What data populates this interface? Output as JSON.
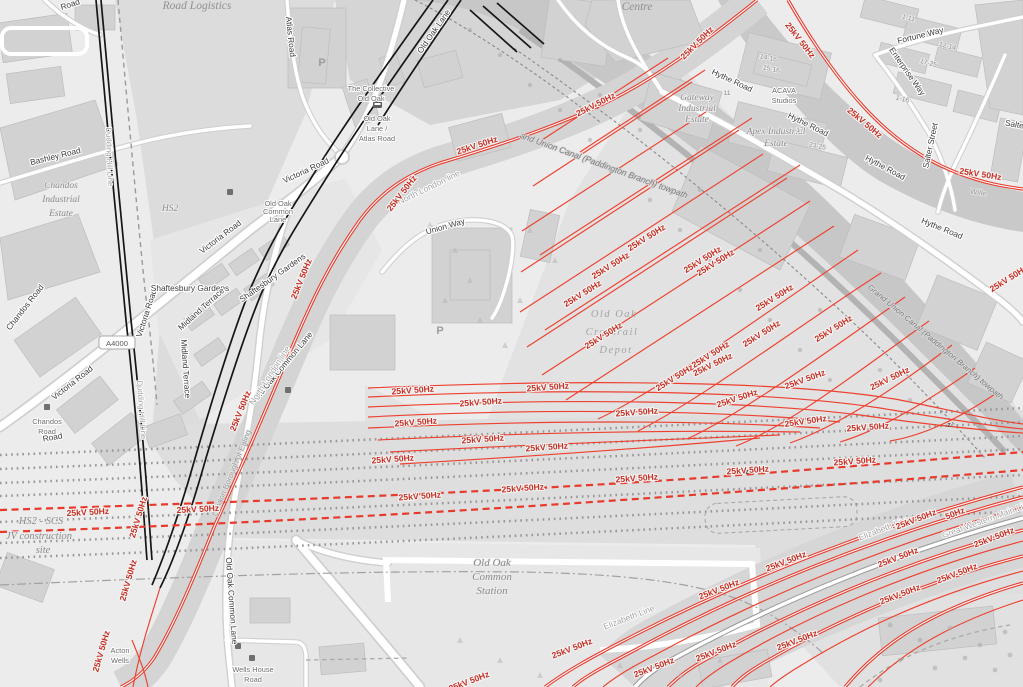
{
  "map": {
    "electrification_label": "25kV 50Hz",
    "electrification_label_short": "50Hz",
    "road_ref_a4000": "A4000",
    "streets": {
      "road_fragment": "Road",
      "atlas_road": "Atlas Road",
      "old_oak_lane": "Old Oak Lane",
      "bashley_road": "Bashley Road",
      "victoria_road": "Victoria Road",
      "old_oak_common_lane": "Old Oak Common Lane",
      "chandos_road": "Chandos Road",
      "shaftesbury_gardens": "Shaftesbury Gardens",
      "midland_terrace": "Midland Terrace",
      "union_way": "Union Way",
      "hythe_road": "Hythe Road",
      "fortune_way": "Fortune Way",
      "enterprise_way": "Enterprise Way",
      "salter_street": "Salter Street",
      "salter_fragment": "Salte",
      "willesden_fragment": "Wille",
      "wells_house_road": [
        "Wells House",
        "Road"
      ]
    },
    "places": {
      "road_logistics": "Road Logistics",
      "centre": "Centre",
      "the_collective": [
        "The Collective",
        "Old Oak"
      ],
      "old_oak_lane_atlas_road": [
        "Old Oak",
        "Lane /",
        "Atlas Road"
      ],
      "old_oak_common_lane_stop": [
        "Old Oak",
        "Common",
        "Lane"
      ],
      "hs2": "HS2",
      "chandos_industrial_estate": [
        "Chandos",
        "Industrial",
        "Estate"
      ],
      "gateway_industrial_estate": [
        "Gateway",
        "Industrial",
        "Estate"
      ],
      "apex_industrial_estate": [
        "Apex Industrial",
        "Estate"
      ],
      "acava_studios": [
        "ACAVA",
        "Studios"
      ],
      "old_oak_crossrail_depot": [
        "Old Oak",
        "Crossrail",
        "Depot"
      ],
      "old_oak_common_station": [
        "Old Oak",
        "Common",
        "Station"
      ],
      "hs2_scs_site": [
        "HS2 - SCS",
        "JV construction",
        "site"
      ],
      "acton_wells": [
        "Acton",
        "Wells"
      ],
      "chandos_road_stop": [
        "Chandos",
        "Road"
      ]
    },
    "railways": {
      "north_london_line": "North London line",
      "dudding_hill_line": "Dudding Hill Line",
      "elizabeth_line": "Elizabeth Line",
      "great_western_main_line": "Great Western Main Line"
    },
    "waterway": {
      "canal_label_partial": "and Union Canal (Paddington Branch) towpath",
      "canal_label_full": "Grand Union Canal (Paddington Branch) towpath"
    },
    "boundary": {
      "ealing": "London Borough of Ealing"
    },
    "house_numbers": {
      "a": "1-11",
      "b": "12-14",
      "c": "17-25",
      "d": "1-16",
      "e": "14-16",
      "f": "15-16",
      "g": "11",
      "h": "17",
      "i": "23-25"
    },
    "icons": {
      "parking": "P"
    },
    "markers": {
      "crossing": "z"
    },
    "colors": {
      "electrified": "#e8392b",
      "label_red": "#c43024"
    }
  }
}
